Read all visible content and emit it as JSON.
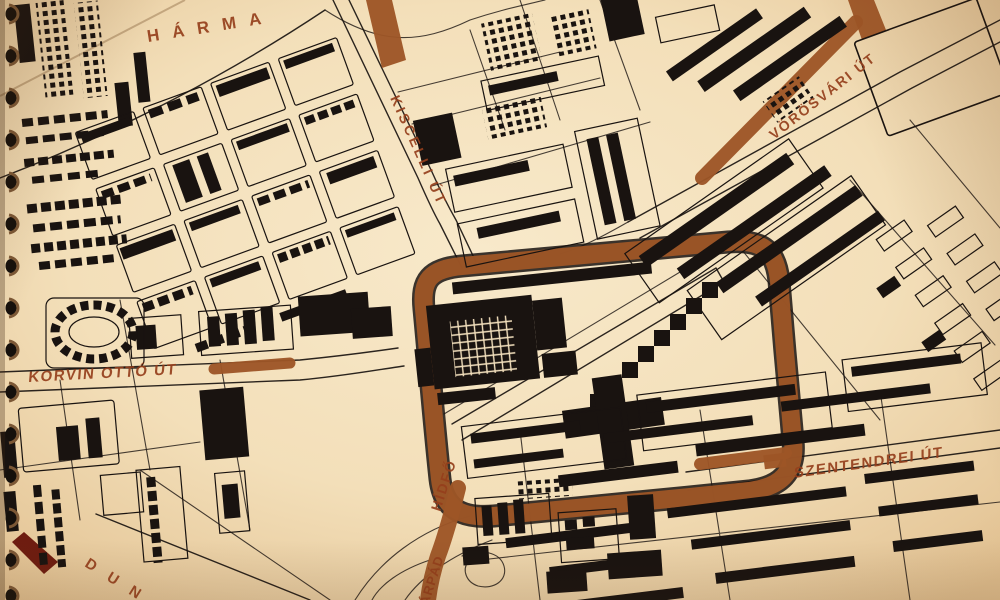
{
  "map": {
    "description": "Scanned spiral-bound city plan of Óbuda with highlighted routes",
    "region_labels": {
      "harmas": "HÁRMA",
      "duna": "DUNA"
    },
    "street_labels": {
      "kiscelli": "KISCELLI ÚT",
      "vorosvari": "VÖRÖSVÁRI ÚT",
      "korvin_otto": "KORVIN OTTÓ ÚT",
      "szentendrei": "SZENTENDREI ÚT",
      "hidfo": "HÍDFŐ",
      "arpad": "ÁRPÁD"
    },
    "colors": {
      "paper": "#f3e0bd",
      "ink": "#191310",
      "highlight_route": "#9d5526",
      "label_text": "#953f1c",
      "accent_dark": "#6e1c10"
    }
  }
}
